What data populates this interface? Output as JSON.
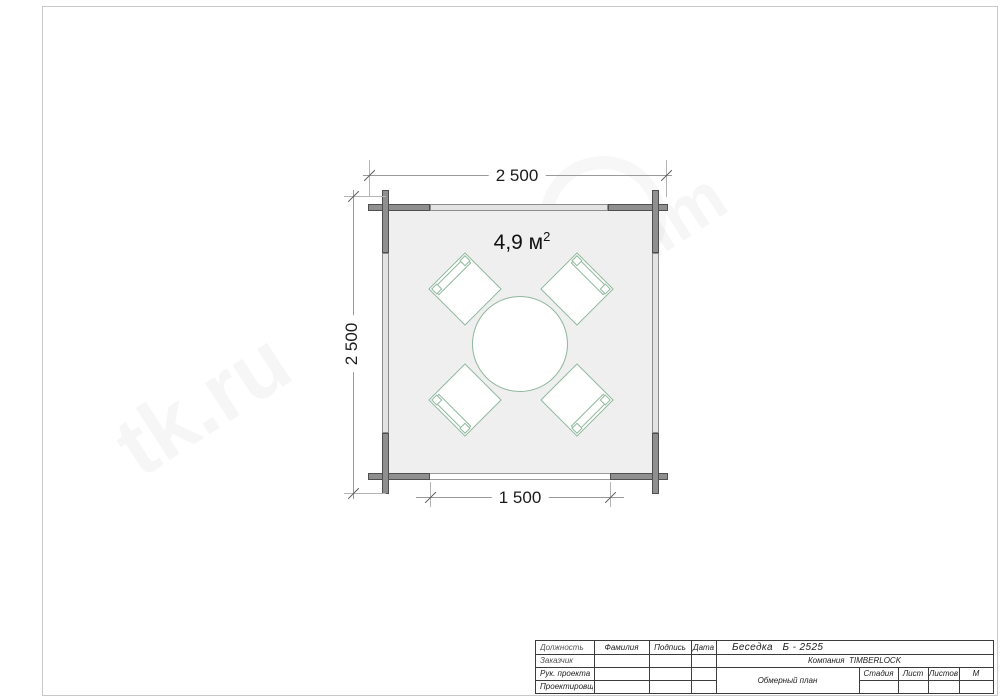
{
  "page": {
    "background": "#ffffff",
    "border_color": "#c8c8c8"
  },
  "plan": {
    "area_value": "4,9 м",
    "area_sup": "2",
    "dim_top": "2 500",
    "dim_left": "2 500",
    "dim_bottom": "1 500",
    "colors": {
      "wall_dark": "#8f8f8f",
      "wall_dark_edge": "#4f4f4f",
      "wall_light": "#e3e3e3",
      "floor": "#efefef",
      "furniture_outline": "#8fb79c",
      "dimension_line": "#9a9a9a",
      "dimension_text": "#1c1c1c"
    }
  },
  "watermark": {
    "text_left": "tk.ru",
    "text_right": "tim"
  },
  "titleblock": {
    "header": {
      "position": "Должность",
      "surname": "Фамилия",
      "signature": "Подпись",
      "date": "Дата"
    },
    "rows": [
      {
        "label": "Заказчик"
      },
      {
        "label": "Рук. проекта"
      },
      {
        "label": "Проектировщик"
      }
    ],
    "project_title": "Беседка   Б - 2525",
    "company": "Компания  TIMBERLOCK",
    "doc_name": "Обмерный план",
    "stage_label": "Стадия",
    "sheet_label": "Лист",
    "sheets_label": "Листов",
    "scale_label": "М"
  }
}
